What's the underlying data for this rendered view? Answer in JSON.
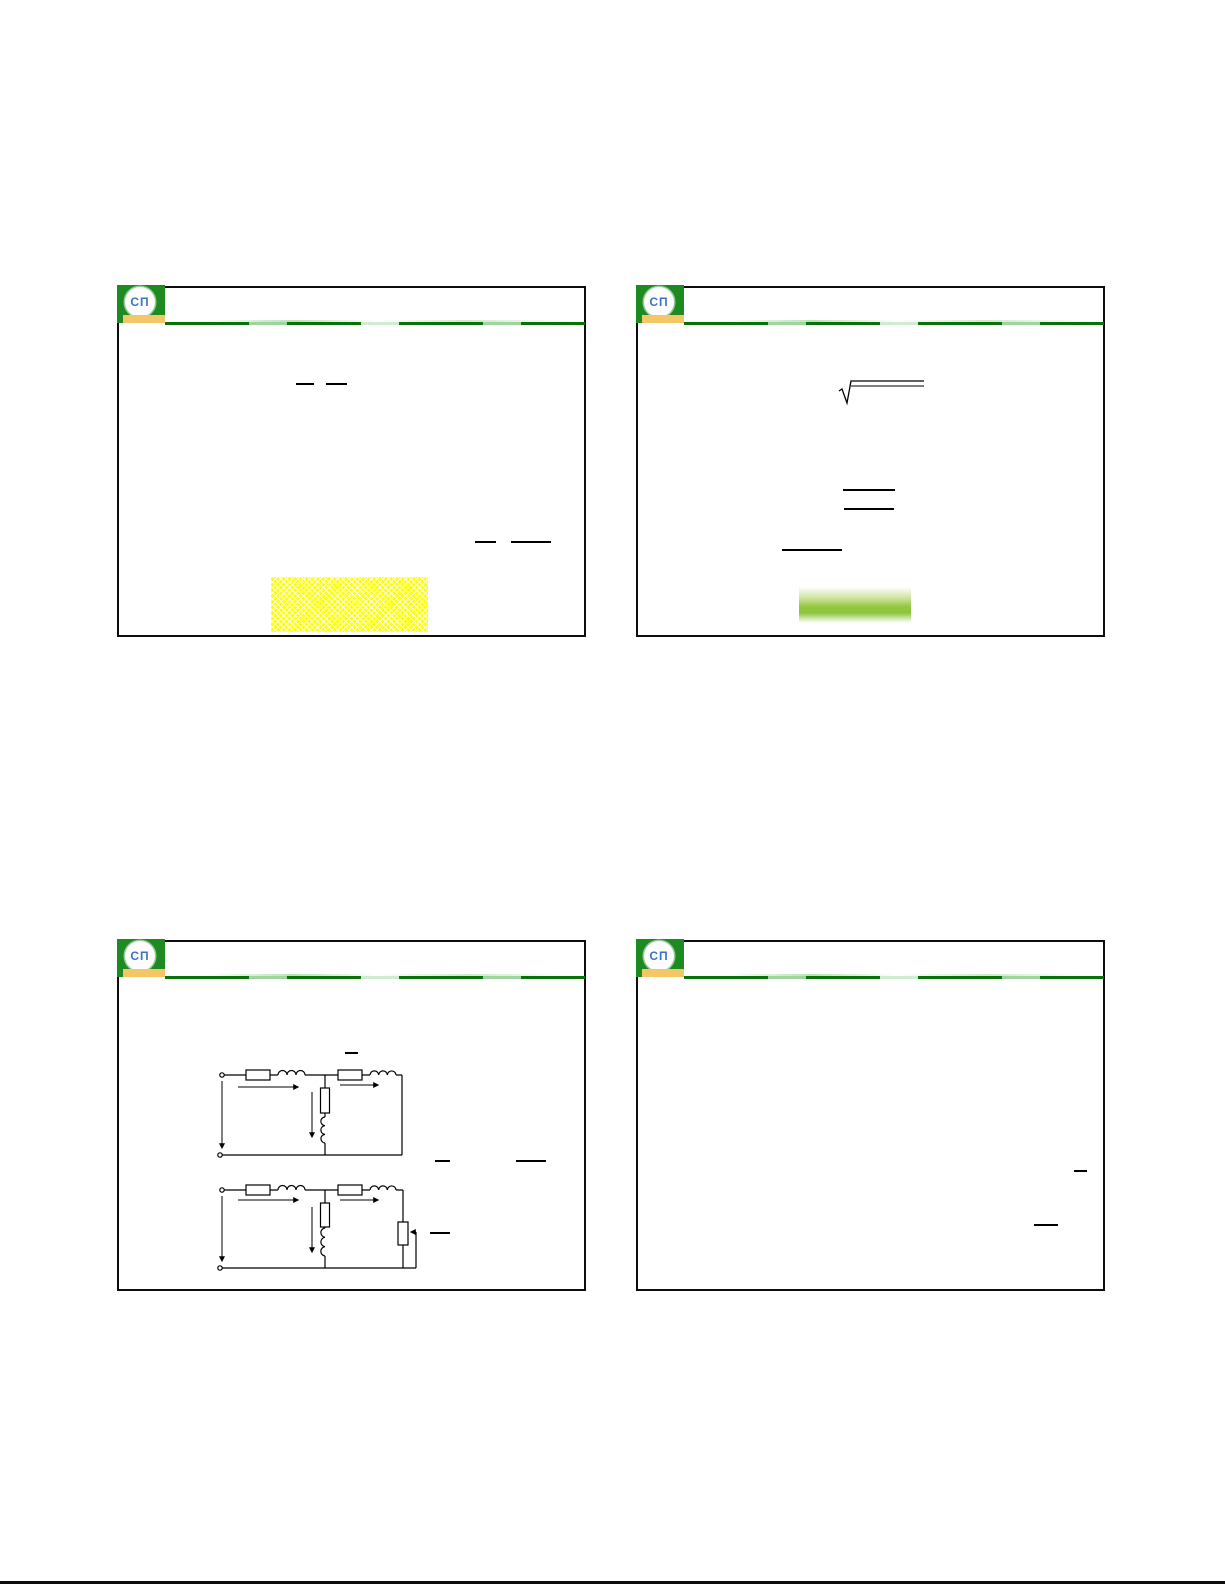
{
  "document": {
    "kind": "presentation handout page, 4 slide frames, no readable body text (only equation bars and diagrams rendered)",
    "slides_per_page": 4
  },
  "logo": {
    "letters": "СП",
    "background_color": "#1e8a22",
    "circle_color": "#ffffff",
    "letters_color": "#3e72c8",
    "base_bar_color": "#f3c766"
  },
  "header_line": {
    "dark_green": "#0a710a",
    "light_green": "#9ed49e"
  },
  "highlights": {
    "yellow_box_color": "#ffff00",
    "yellow_box_pattern": "white diamond lattice",
    "green_bar_color": "#8cc63e"
  },
  "equation_ink_color": "#000000",
  "slide_border_color": "#0d0d0d",
  "page_background": "#ffffff",
  "slides": [
    {
      "position": "top-left",
      "fraction_bars": 4,
      "highlight": "yellow dotted box"
    },
    {
      "position": "top-right",
      "fraction_bars": 3,
      "radical_signs": 1,
      "highlight": "green gradient bar"
    },
    {
      "position": "bottom-left",
      "fraction_bars": 4,
      "circuit_diagrams": 2
    },
    {
      "position": "bottom-right",
      "fraction_bars": 2
    }
  ]
}
